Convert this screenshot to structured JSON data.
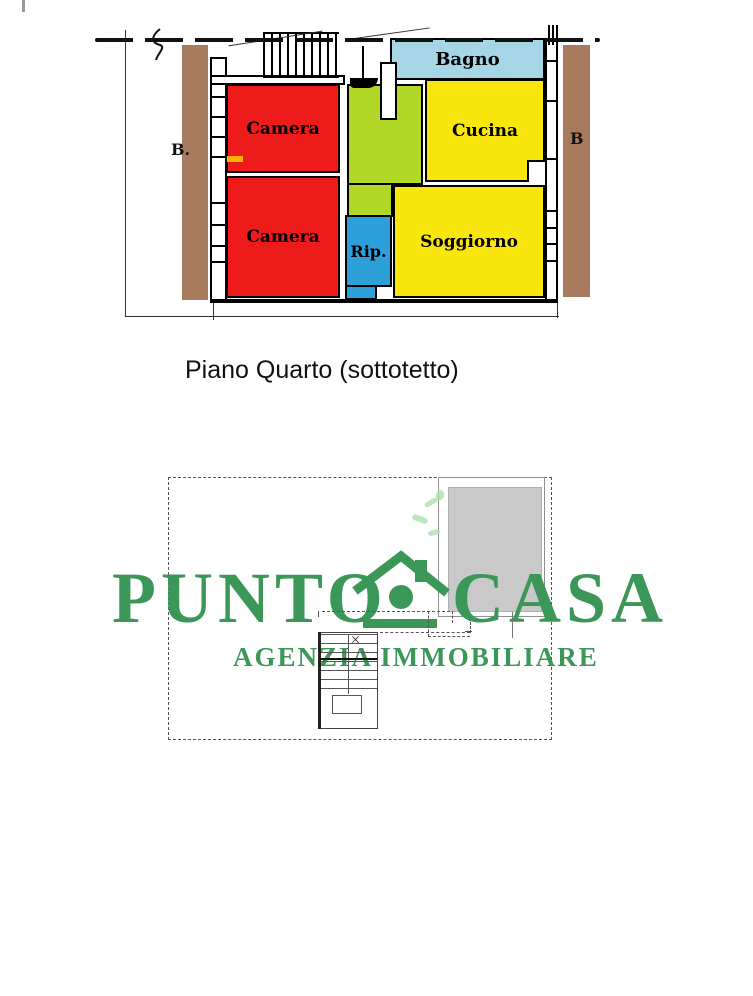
{
  "floor_plan": {
    "caption": "Piano Quarto (sottotetto)",
    "rooms": {
      "bagno": {
        "label": "Bagno",
        "color": "#a6d6e6"
      },
      "cucina": {
        "label": "Cucina",
        "color": "#f8e60d"
      },
      "camera_top": {
        "label": "Camera",
        "color": "#ee1b1b"
      },
      "camera_bottom": {
        "label": "Camera",
        "color": "#ee1b1b"
      },
      "rip": {
        "label": "Rip.",
        "color": "#2d9fd9"
      },
      "soggiorno": {
        "label": "Soggiorno",
        "color": "#f8e60d"
      },
      "hallway": {
        "label": "",
        "color": "#b2d827"
      }
    },
    "balconies": {
      "left": {
        "label": "B.",
        "color": "#a87b5f"
      },
      "right": {
        "label": "B",
        "color": "#a87b5f"
      }
    }
  },
  "watermark": {
    "brand_left": "PUNTO",
    "brand_right": "CASA",
    "tagline": "AGENZIA IMMOBILIARE",
    "color": "#3b9757",
    "house_icon": "house-with-chimney-icon"
  },
  "lower_plan": {
    "terrace_fill": "#c9c9c9"
  }
}
